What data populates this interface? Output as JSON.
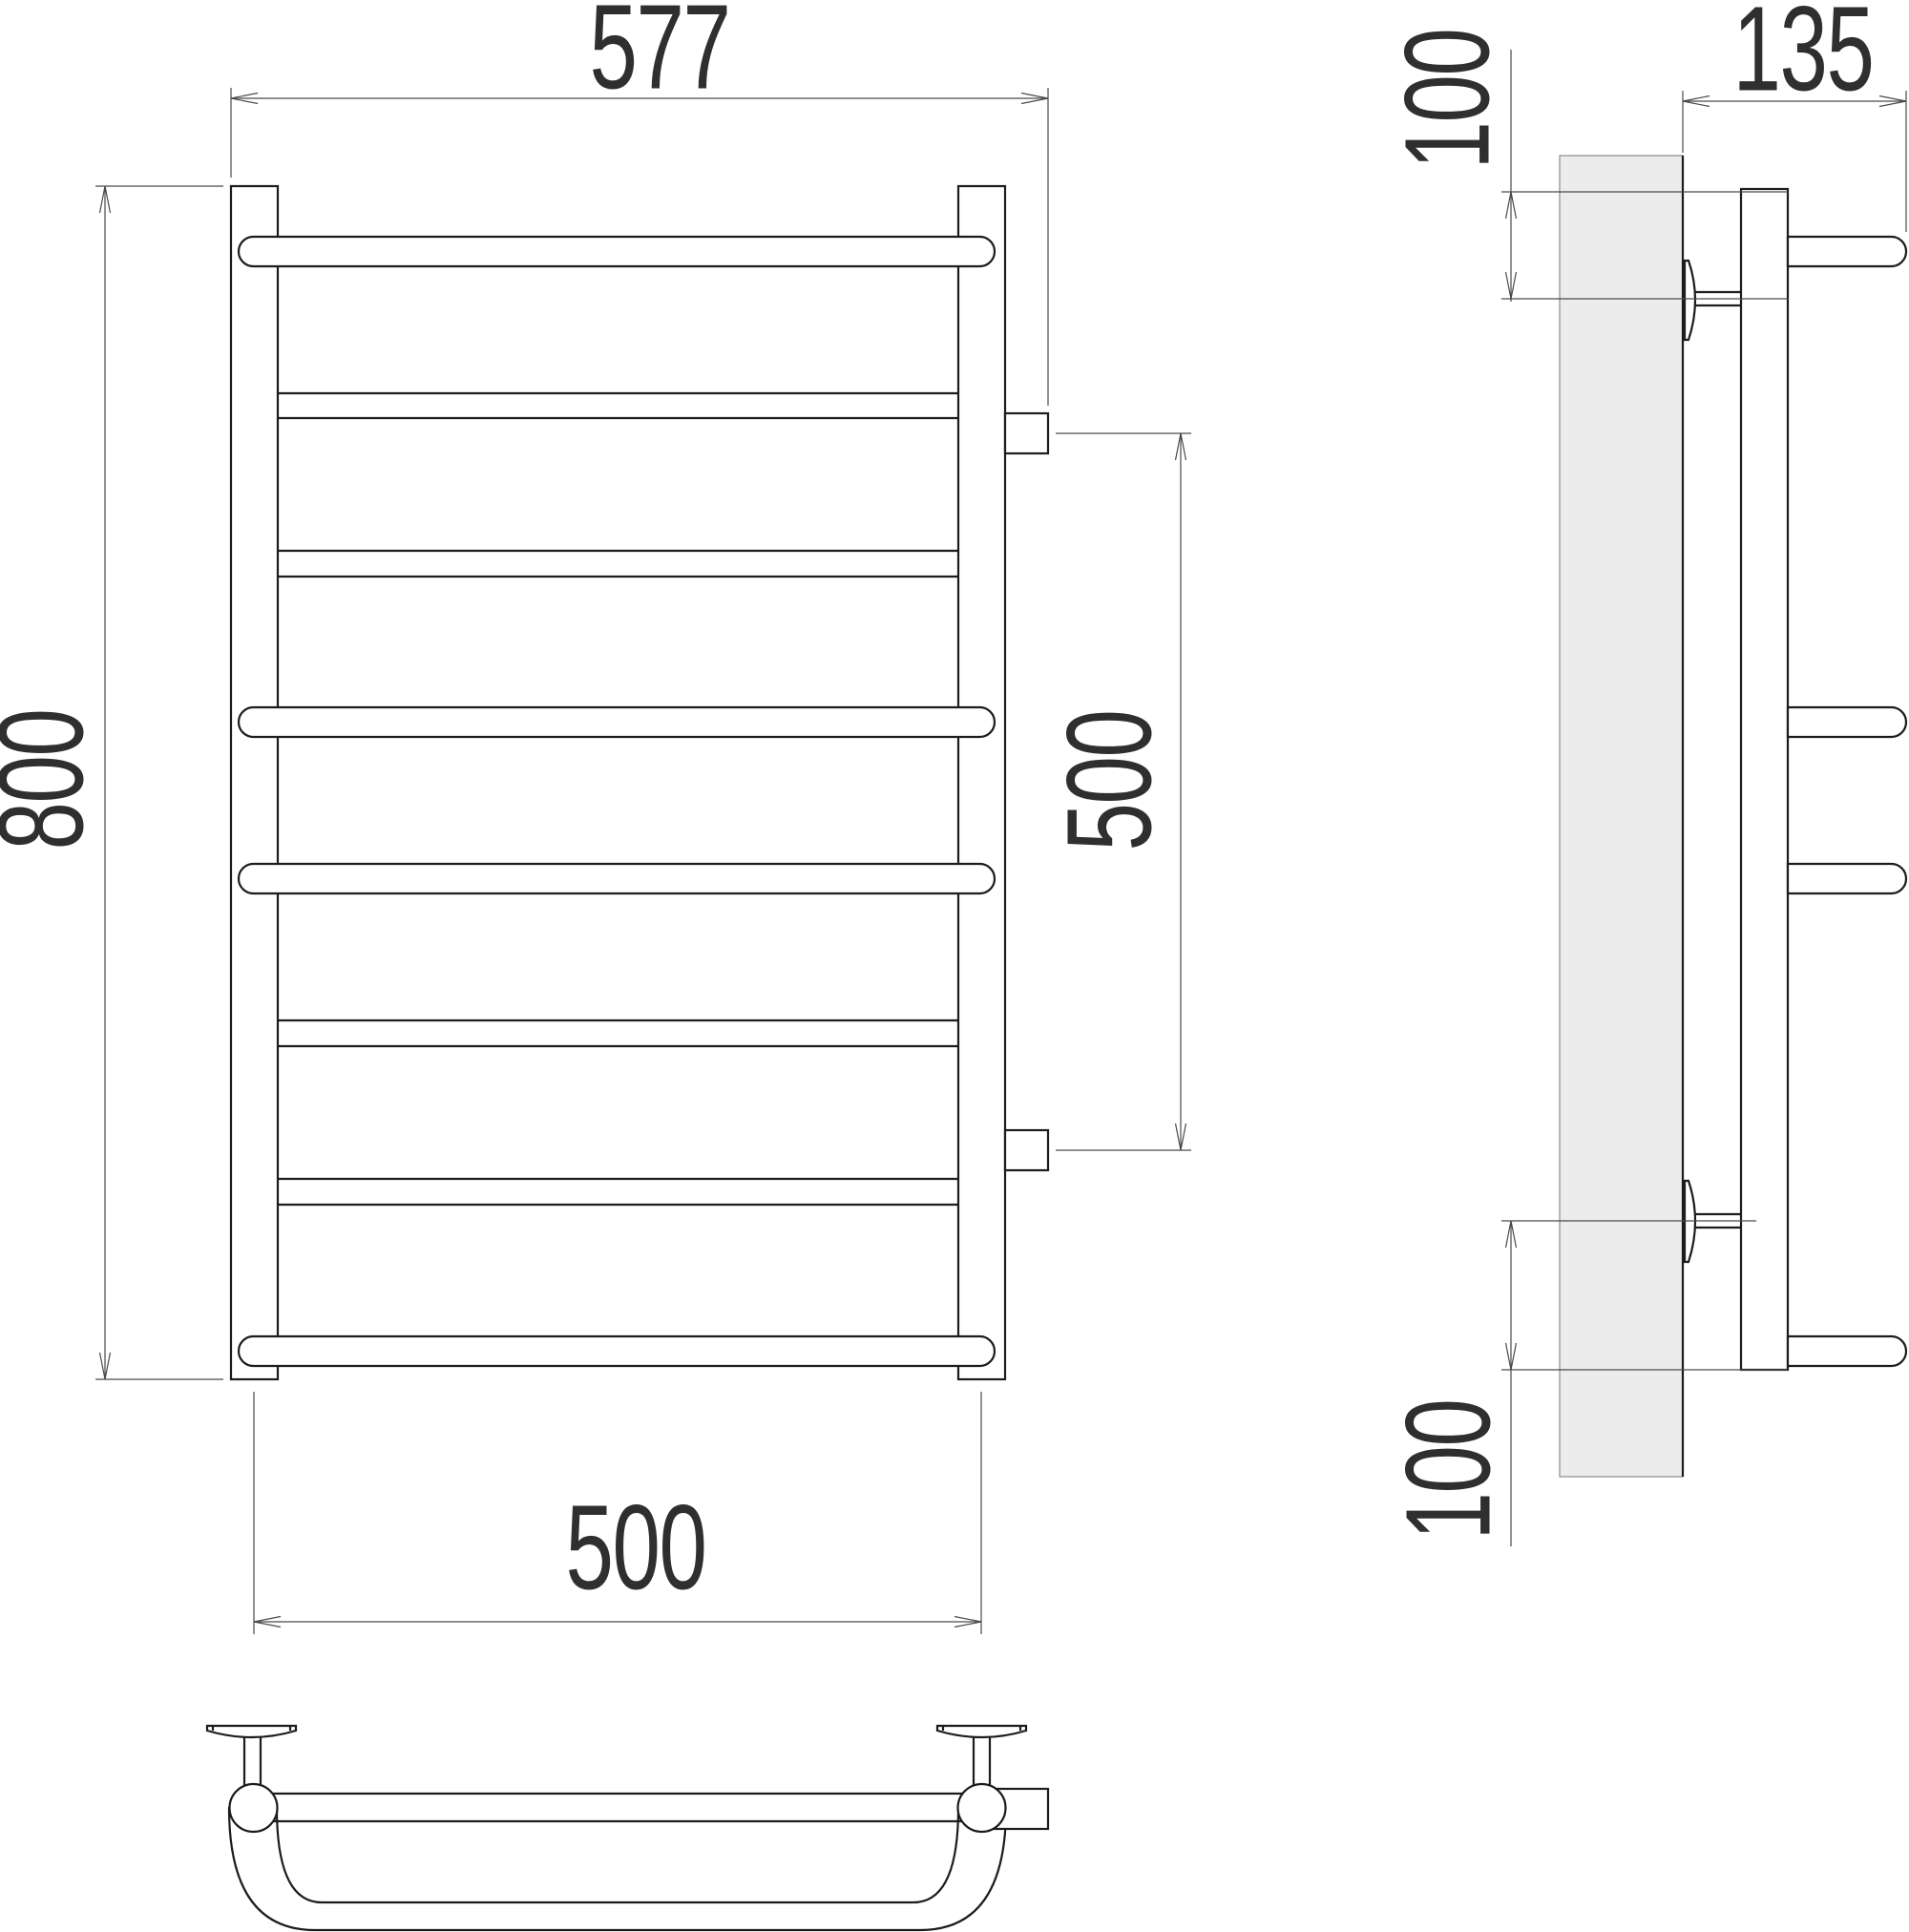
{
  "drawing": {
    "type": "technical-drawing",
    "subject": "ladder towel rail, three orthographic views",
    "colors": {
      "line": "#1c1c1c",
      "dimension": "#4a4a4a",
      "wall_fill": "#ececec",
      "background": "#ffffff"
    },
    "dimensions": {
      "overall_width": "577",
      "overall_height": "800",
      "connection_spacing": "500",
      "bottom_axle_spacing": "500",
      "side_depth": "135",
      "top_offset": "100",
      "bottom_offset": "100"
    }
  }
}
